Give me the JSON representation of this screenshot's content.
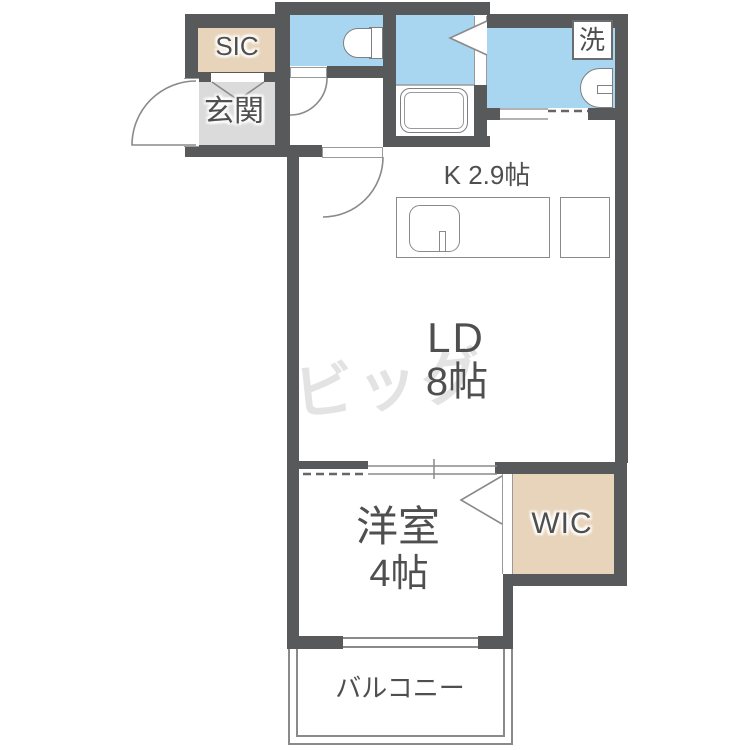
{
  "floorplan": {
    "rooms": {
      "sic": {
        "label": "SIC"
      },
      "genkan": {
        "label": "玄関"
      },
      "laundry": {
        "label": "洗"
      },
      "kitchen": {
        "label": "K 2.9帖"
      },
      "living": {
        "label": "LD",
        "size": "8帖"
      },
      "bedroom": {
        "label": "洋室",
        "size": "4帖"
      },
      "wic": {
        "label": "WIC"
      },
      "balcony": {
        "label": "バルコニー"
      }
    },
    "watermark": "ビッグ",
    "fixtures": [
      "toilet",
      "bathtub",
      "washer-pan",
      "vanity-sink",
      "kitchen-counter",
      "kitchen-sink",
      "fridge-space"
    ],
    "colors": {
      "wall": "#58595b",
      "wet_room_blue": "#a8d6f0",
      "closet_tan": "#e7d4ba",
      "entry_gray": "#dbdbdb",
      "label_text": "#4f4f4f",
      "watermark_gray": "#e3e3e3",
      "line_gray": "#8a8a8a"
    }
  }
}
